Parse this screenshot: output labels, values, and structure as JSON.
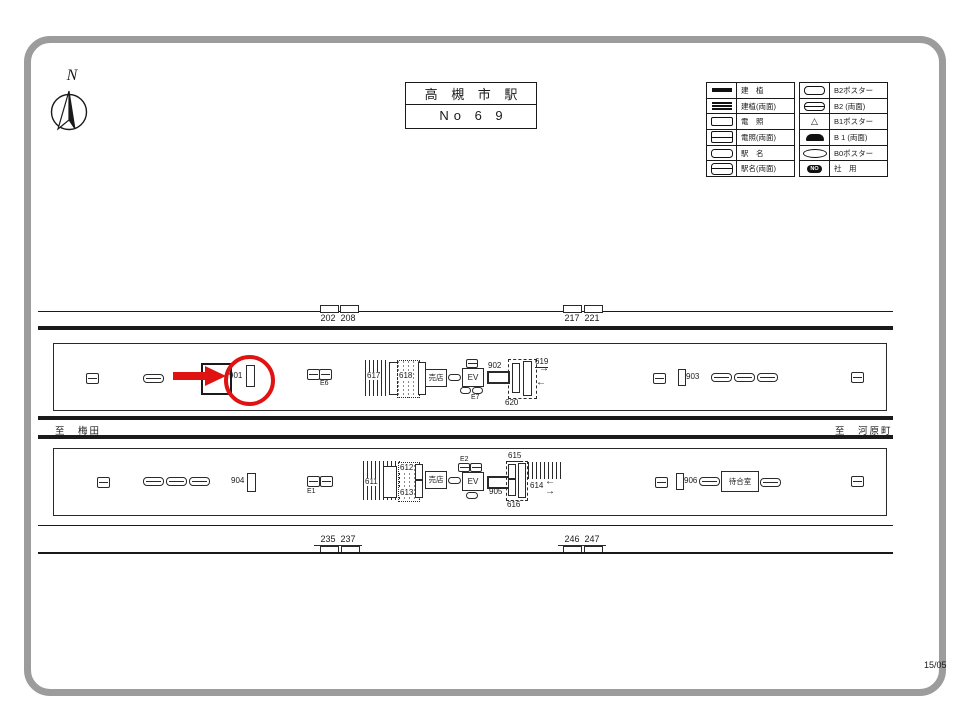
{
  "page": {
    "code": "15/05"
  },
  "compass": {
    "north": "N"
  },
  "title": {
    "station": "高 槻 市 駅",
    "number": "No 6 9"
  },
  "icons": {
    "triangle": "△"
  },
  "arrows": {
    "right": "→",
    "left": "←"
  },
  "legend": {
    "left": [
      {
        "label": "建　植"
      },
      {
        "label": "建植(両面)"
      },
      {
        "label": "電　照"
      },
      {
        "label": "電照(両面)"
      },
      {
        "label": "駅　名"
      },
      {
        "label": "駅名(両面)"
      }
    ],
    "right": [
      {
        "label": "B2ポスター"
      },
      {
        "label": "B2 (両面)"
      },
      {
        "label": "B1ポスター"
      },
      {
        "label": "B 1 (両面)"
      },
      {
        "label": "B0ポスター"
      },
      {
        "label": "社　用",
        "badge": "NO"
      }
    ]
  },
  "tracks": {
    "top_wall": [
      {
        "left": "202",
        "right": "208"
      },
      {
        "left": "217",
        "right": "221"
      }
    ],
    "bottom_wall": [
      {
        "left": "235",
        "right": "237"
      },
      {
        "left": "246",
        "right": "247"
      }
    ],
    "to_left": "至　梅田",
    "to_right": "至　河原町"
  },
  "platform_top": {
    "highlight": "901",
    "sign_902": "902",
    "board_903": "903",
    "stairs_617": "617",
    "stairs_618": "618",
    "esc_619": "619",
    "stairs_620": "620",
    "exit_e6": "E6",
    "exit_e7": "E7",
    "shop": "売店",
    "elevator": "EV"
  },
  "platform_bottom": {
    "board_904": "904",
    "sign_905": "905",
    "board_906": "906",
    "stairs_611": "611",
    "stairs_612": "612",
    "stairs_613": "613",
    "esc_614": "614",
    "stairs_615": "615",
    "stairs_616": "616",
    "exit_e1": "E1",
    "exit_e2": "E2",
    "shop": "売店",
    "elevator": "EV",
    "waiting_room": "待合室"
  },
  "colors": {
    "highlight": "#e01313",
    "line": "#1a1a1a",
    "frame": "#9c9c9c"
  }
}
